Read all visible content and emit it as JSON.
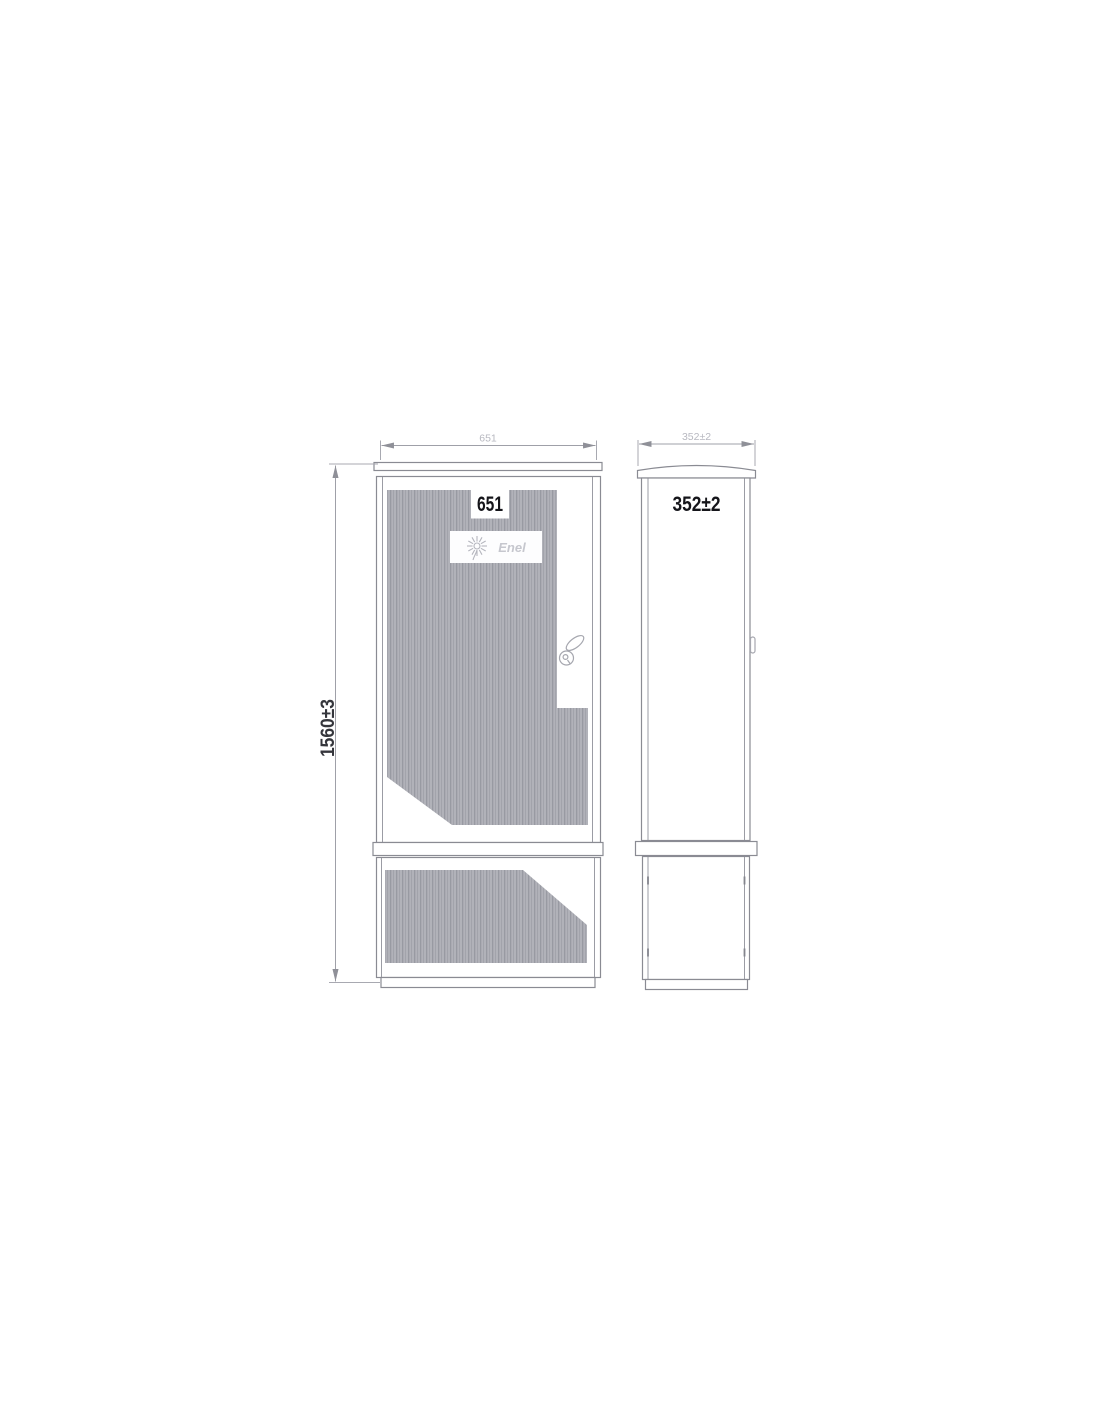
{
  "drawing": {
    "labels": {
      "width_overlay": "651",
      "depth_overlay": "352±2",
      "height": "1560±3",
      "width_faint": "651",
      "depth_faint": "352±2"
    },
    "logo": {
      "brand": "Enel"
    },
    "colors": {
      "background": "#ffffff",
      "outline": "#8a8b93",
      "inner_line": "#9b9ca4",
      "hatch_light": "#b1b2b9",
      "hatch_dark": "#989aa2",
      "dim_faint_text": "#b4b5bd",
      "overlay_label_text": "#15151a",
      "height_label_text": "#35363c",
      "logo_gray": "#b5b6be"
    }
  }
}
